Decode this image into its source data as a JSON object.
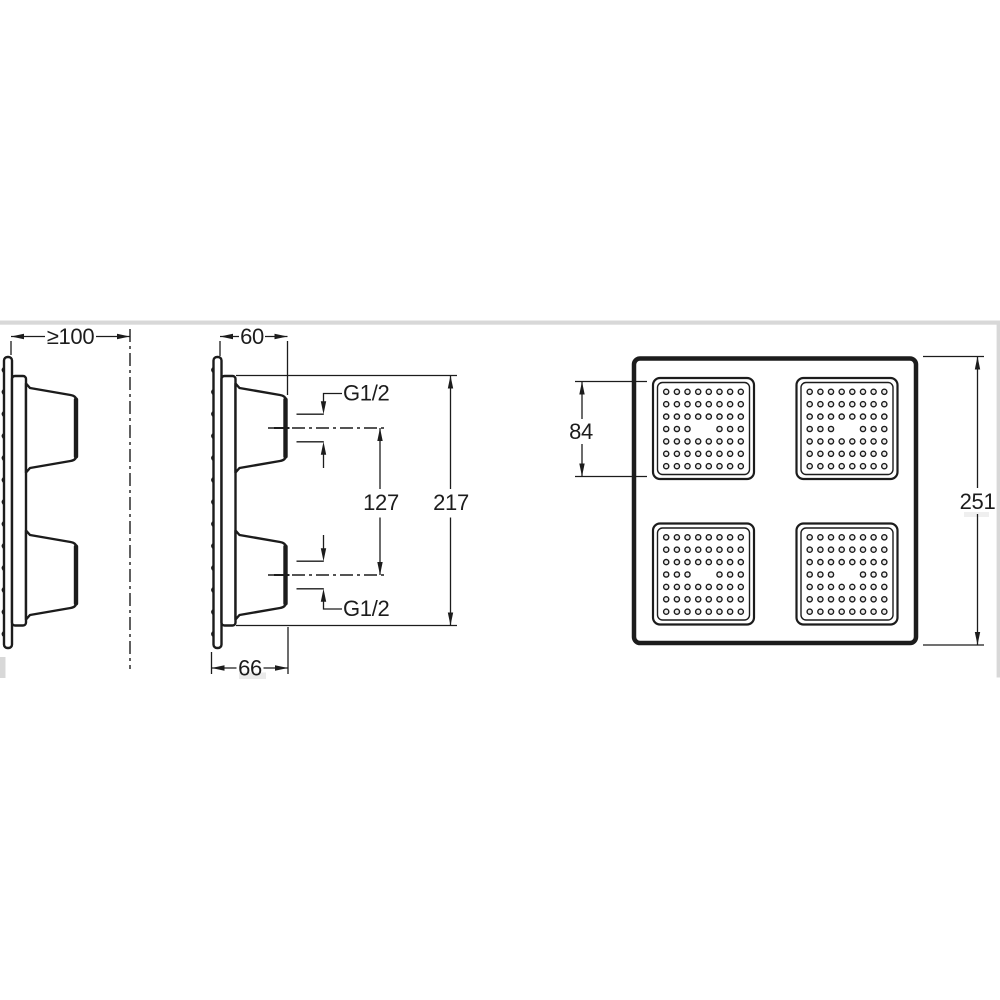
{
  "drawing": {
    "line_color": "#1c1c1c",
    "background_color": "#ffffff",
    "artifact_gray": "#d8d8d8",
    "views": {
      "side_left": {
        "dim_min_wall_distance": "≥100"
      },
      "side_middle": {
        "dim_depth_top": "60",
        "dim_depth_bottom": "66",
        "dim_inlet_spacing": "127",
        "dim_overall_height": "217",
        "label_inlet_top": "G1/2",
        "label_inlet_bottom": "G1/2"
      },
      "front": {
        "dim_spray_panel": "84",
        "dim_overall": "251",
        "nozzle_grid": {
          "panels": 4,
          "rows": 7,
          "cols": 8,
          "missing_cells": [
            [
              3,
              3
            ],
            [
              3,
              4
            ]
          ],
          "nozzles_per_panel": 54
        }
      }
    }
  }
}
